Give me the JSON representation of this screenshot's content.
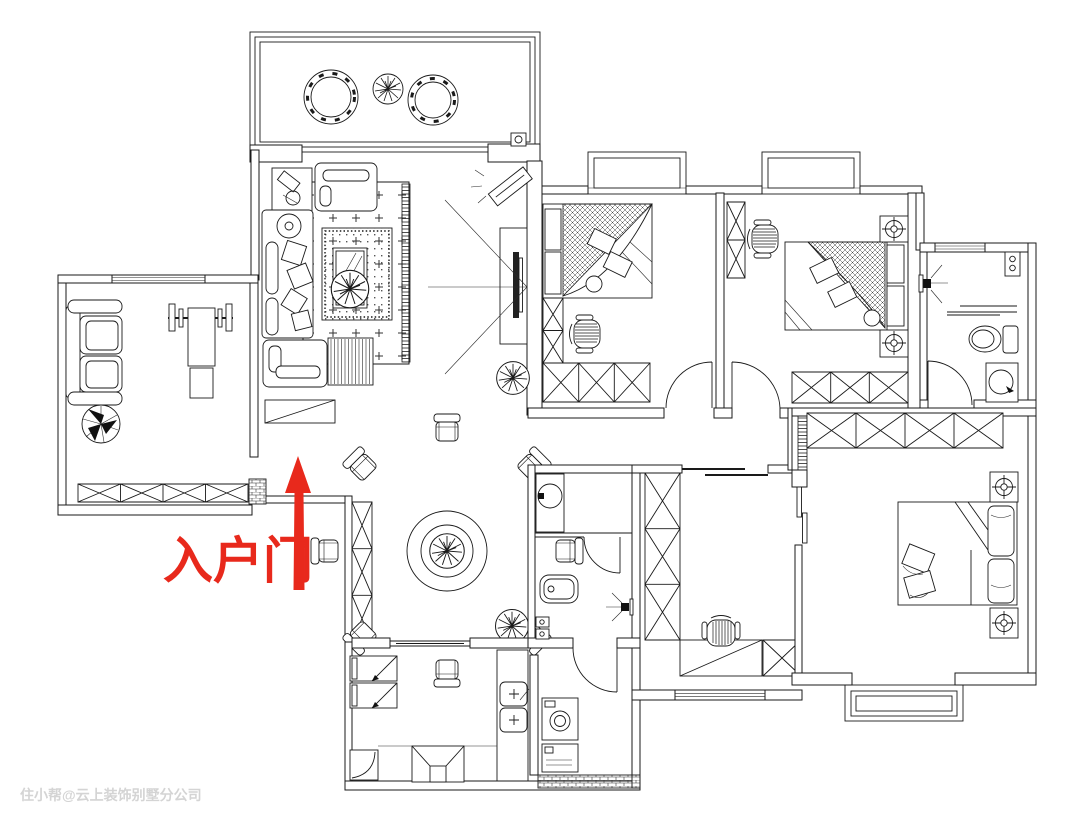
{
  "annotation": {
    "entry_label": "入户门",
    "arrow_color": "#e8291c"
  },
  "watermark": {
    "text": "住小帮@云上装饰别墅分公司",
    "color": "#d4d4d4"
  },
  "canvas": {
    "width": 1080,
    "height": 830,
    "background": "#ffffff",
    "line_color": "#1a1a1a"
  }
}
